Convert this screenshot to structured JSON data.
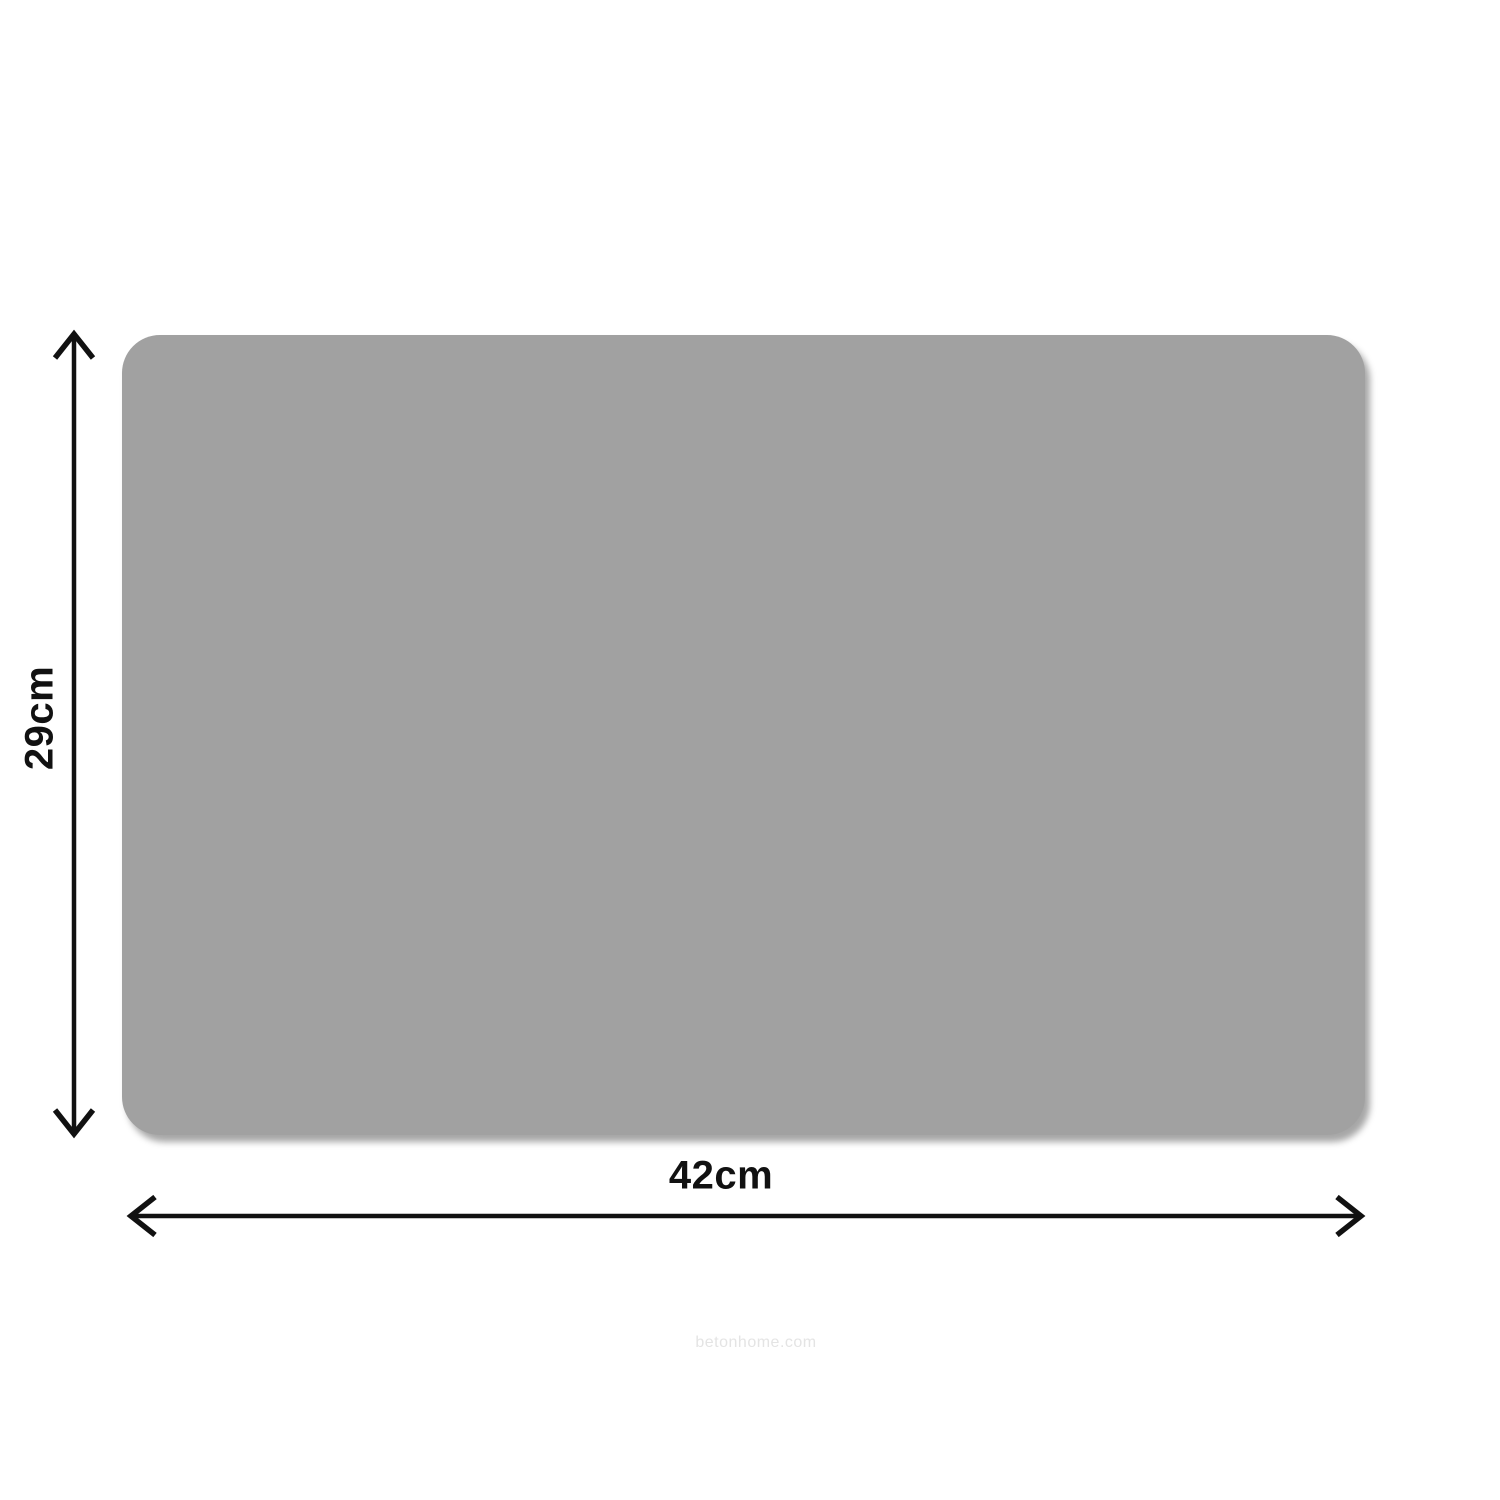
{
  "dimensions": {
    "height": {
      "label": "29cm"
    },
    "width": {
      "label": "42cm"
    }
  },
  "watermark": {
    "text": "betonhome.com"
  },
  "colors": {
    "background": "#ffffff",
    "mat_fill": "#a1a1a1",
    "arrow": "#111111",
    "label": "#111111",
    "watermark": "#e4e4e4"
  }
}
